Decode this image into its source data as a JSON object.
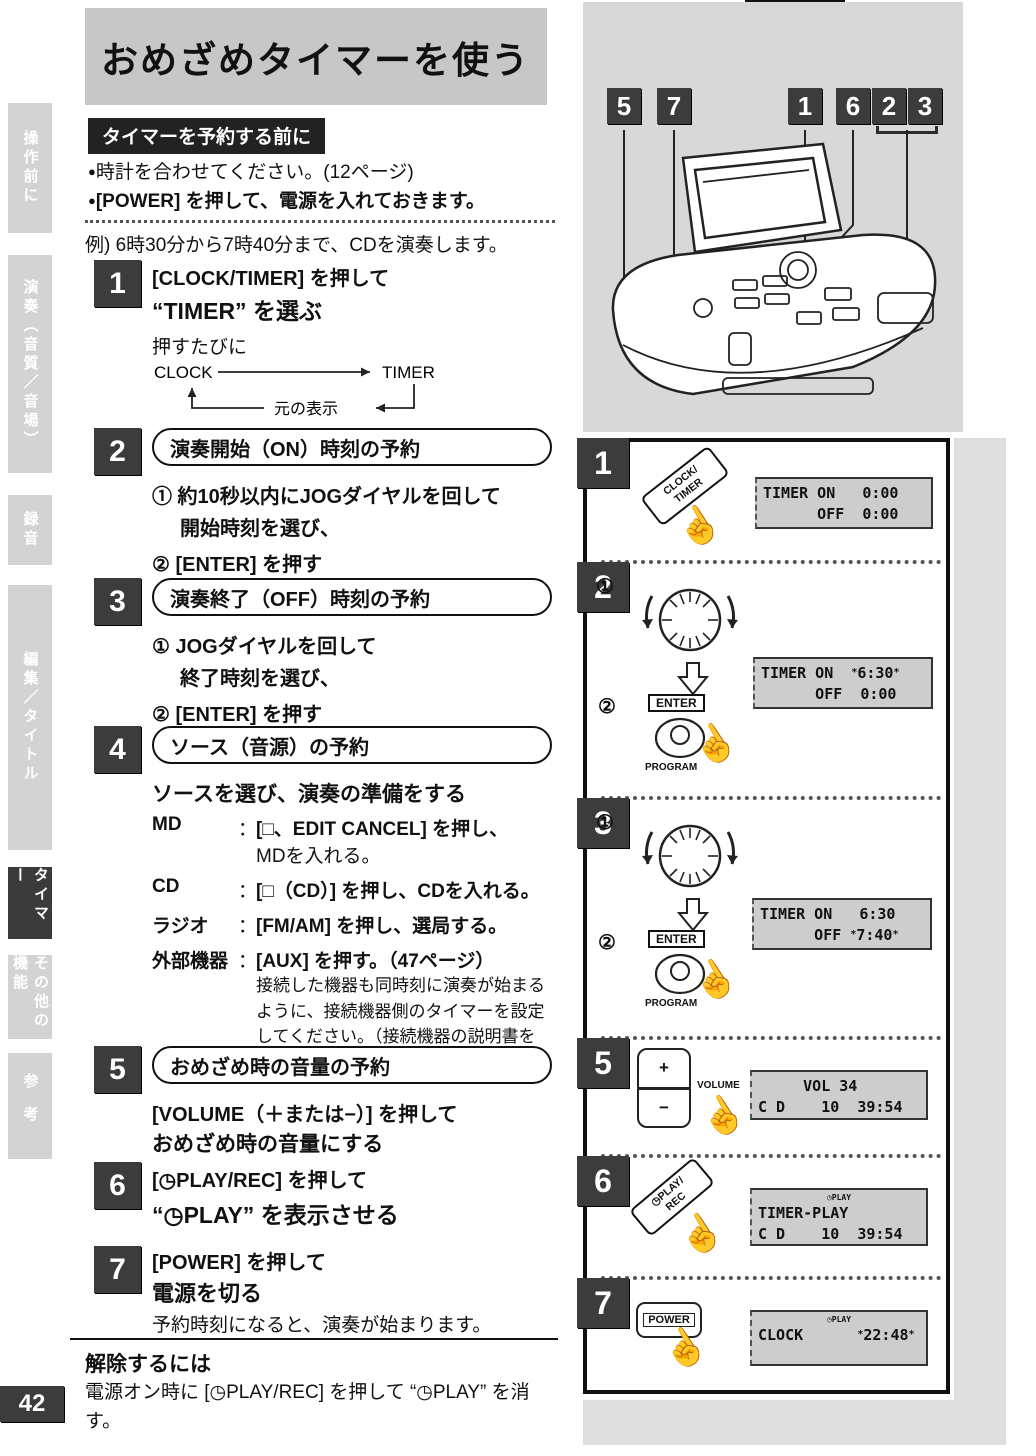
{
  "page": {
    "number": "42"
  },
  "icons": {
    "hand": "☝",
    "bullet": "●"
  },
  "header": {
    "title": "おめざめタイマーを使う"
  },
  "sidebar": {
    "tabs": [
      {
        "label": "操作前に",
        "active": false
      },
      {
        "label": "演奏（音質／音場）",
        "active": false
      },
      {
        "label": "録音",
        "active": false
      },
      {
        "label": "編集／タイトル",
        "active": false
      },
      {
        "label": "タイマー",
        "active": true
      },
      {
        "label": "その他の機能",
        "active": false
      },
      {
        "label": "参考",
        "active": false
      }
    ]
  },
  "intro": {
    "heading": "タイマーを予約する前に",
    "bullets": [
      {
        "text": "時計を合わせてください。(12ページ)"
      },
      {
        "text": "[POWER] を押して、電源を入れておきます。"
      }
    ],
    "example": "例) 6時30分から7時40分まで、CDを演奏します。"
  },
  "steps": {
    "s1": {
      "num": "1",
      "line1": "[CLOCK/TIMER] を押して",
      "line2": "“TIMER” を選ぶ",
      "sub": "押すたびに",
      "diag": {
        "from": "CLOCK",
        "to": "TIMER",
        "back": "元の表示"
      }
    },
    "s2": {
      "num": "2",
      "pill": "演奏開始（ON）時刻の予約",
      "i1a": "① 約10秒以内にJOGダイヤルを回して",
      "i1b": "開始時刻を選び、",
      "i2": "② [ENTER] を押す"
    },
    "s3": {
      "num": "3",
      "pill": "演奏終了（OFF）時刻の予約",
      "i1a": "① JOGダイヤルを回して",
      "i1b": "終了時刻を選び、",
      "i2": "② [ENTER] を押す"
    },
    "s4": {
      "num": "4",
      "pill": "ソース（音源）の予約",
      "lead": "ソースを選び、演奏の準備をする",
      "rows": [
        {
          "label": "MD",
          "sep": "：",
          "desc1": "[□、EDIT CANCEL] を押し、",
          "desc2": "MDを入れる。"
        },
        {
          "label": "CD",
          "sep": "：",
          "desc1": "[□（CD）] を押し、CDを入れる。"
        },
        {
          "label": "ラジオ",
          "sep": "：",
          "desc1": "[FM/AM] を押し、選局する。"
        },
        {
          "label": "外部機器",
          "sep": "：",
          "desc1": "[AUX] を押す。（47ページ）",
          "note": "接続した機器も同時刻に演奏が始まるように、接続機器側のタイマーを設定してください。（接続機器の説明書をご覧ください。）"
        }
      ]
    },
    "s5": {
      "num": "5",
      "pill": "おめざめ時の音量の予約",
      "line1": "[VOLUME（＋または−）] を押して",
      "line2": "おめざめ時の音量にする"
    },
    "s6": {
      "num": "6",
      "line1": "[◷PLAY/REC] を押して",
      "line2": "“◷PLAY” を表示させる"
    },
    "s7": {
      "num": "7",
      "line1": "[POWER] を押して",
      "line2": "電源を切る",
      "note": "予約時刻になると、演奏が始まります。"
    }
  },
  "cancel": {
    "title": "解除するには",
    "body": "電源オン時に [◷PLAY/REC] を押して “◷PLAY” を消す。"
  },
  "device": {
    "callouts": [
      "5",
      "7",
      "1",
      "6",
      "2",
      "3"
    ]
  },
  "panels": {
    "p1": {
      "num": "1",
      "button_l1": "CLOCK/",
      "button_l2": "TIMER",
      "lcd_r1": "TIMER ON   0:00",
      "lcd_r2": "      OFF  0:00"
    },
    "p2": {
      "num": "2",
      "step1": "①",
      "step2": "②",
      "enter": "ENTER",
      "program": "PROGRAM",
      "lcd_r1_pre": "TIMER ON  ",
      "lcd_r1_blink": "6:30",
      "lcd_r2": "      OFF  0:00"
    },
    "p3": {
      "num": "3",
      "step1": "①",
      "step2": "②",
      "enter": "ENTER",
      "program": "PROGRAM",
      "lcd_r1": "TIMER ON   6:30",
      "lcd_r2_pre": "      OFF ",
      "lcd_r2_blink": "7:40"
    },
    "p5": {
      "num": "5",
      "plus": "+",
      "minus": "−",
      "volume": "VOLUME",
      "lcd_r1": "     VOL 34",
      "lcd_r2": "C D    10  39:54"
    },
    "p6": {
      "num": "6",
      "button_l1": "◷PLAY/",
      "button_l2": "REC",
      "lcd_ind": "◷PLAY",
      "lcd_r1": "TIMER-PLAY",
      "lcd_r2": "C D    10  39:54"
    },
    "p7": {
      "num": "7",
      "power": "POWER",
      "lcd_ind": "◷PLAY",
      "lcd_r1_pre": "CLOCK      ",
      "lcd_r1_blink": "22:48"
    }
  }
}
